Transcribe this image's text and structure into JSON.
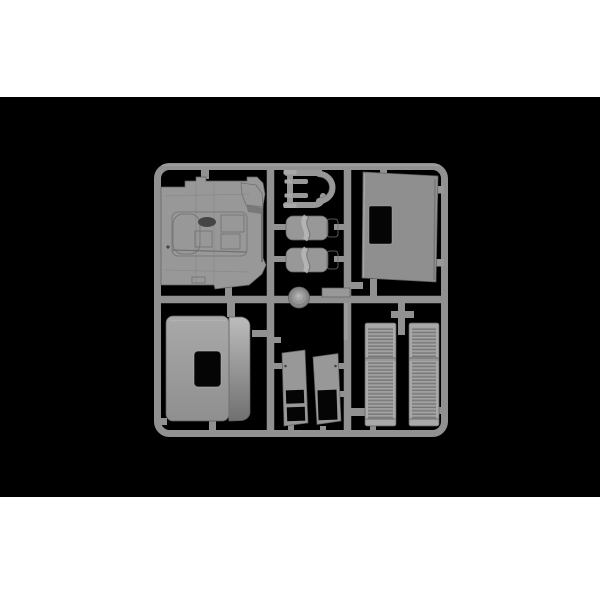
{
  "image": {
    "type": "product-photo",
    "description": "Grey injection-moulded model kit sprue (parts tree) with truck cab components, photographed on a black background with white bands above and below",
    "page_bg": "#ffffff",
    "photo_bg": "#000000"
  },
  "colors": {
    "page_bg": "#ffffff",
    "photo_bg": "#000000",
    "runner": "#919191",
    "runner_edge": "#5f5f5f",
    "plastic": "#989898",
    "plastic_light": "#a9a9a9",
    "plastic_lighter": "#bcbcbc",
    "plastic_mid": "#8f8f8f",
    "plastic_dark": "#707070",
    "plastic_deep": "#454545",
    "hole": "#050505"
  },
  "parts": [
    {
      "id": "sprue-frame",
      "name": "Sprue runner frame with cross dividers"
    },
    {
      "id": "cab-floor",
      "name": "Cab floor interior tub with engine cover"
    },
    {
      "id": "exhaust-pipes",
      "name": "Exhaust pipe assembly with flanged stack"
    },
    {
      "id": "seat-upper",
      "name": "Truck seat (upper)"
    },
    {
      "id": "seat-lower",
      "name": "Truck seat (lower)"
    },
    {
      "id": "horn-dome",
      "name": "Round dome hub on runner"
    },
    {
      "id": "mount-plate",
      "name": "Small rectangular mounting plate"
    },
    {
      "id": "rear-panel",
      "name": "Cab rear panel with window opening"
    },
    {
      "id": "roof-panel",
      "name": "Cab roof panel with hatch opening"
    },
    {
      "id": "door-card-left",
      "name": "Small panel with two rectangular openings"
    },
    {
      "id": "door-card-right",
      "name": "Small panel with one rectangular opening"
    },
    {
      "id": "grille-left",
      "name": "Ribbed grille step panel (left)"
    },
    {
      "id": "grille-right",
      "name": "Ribbed grille step panel (right)"
    }
  ]
}
